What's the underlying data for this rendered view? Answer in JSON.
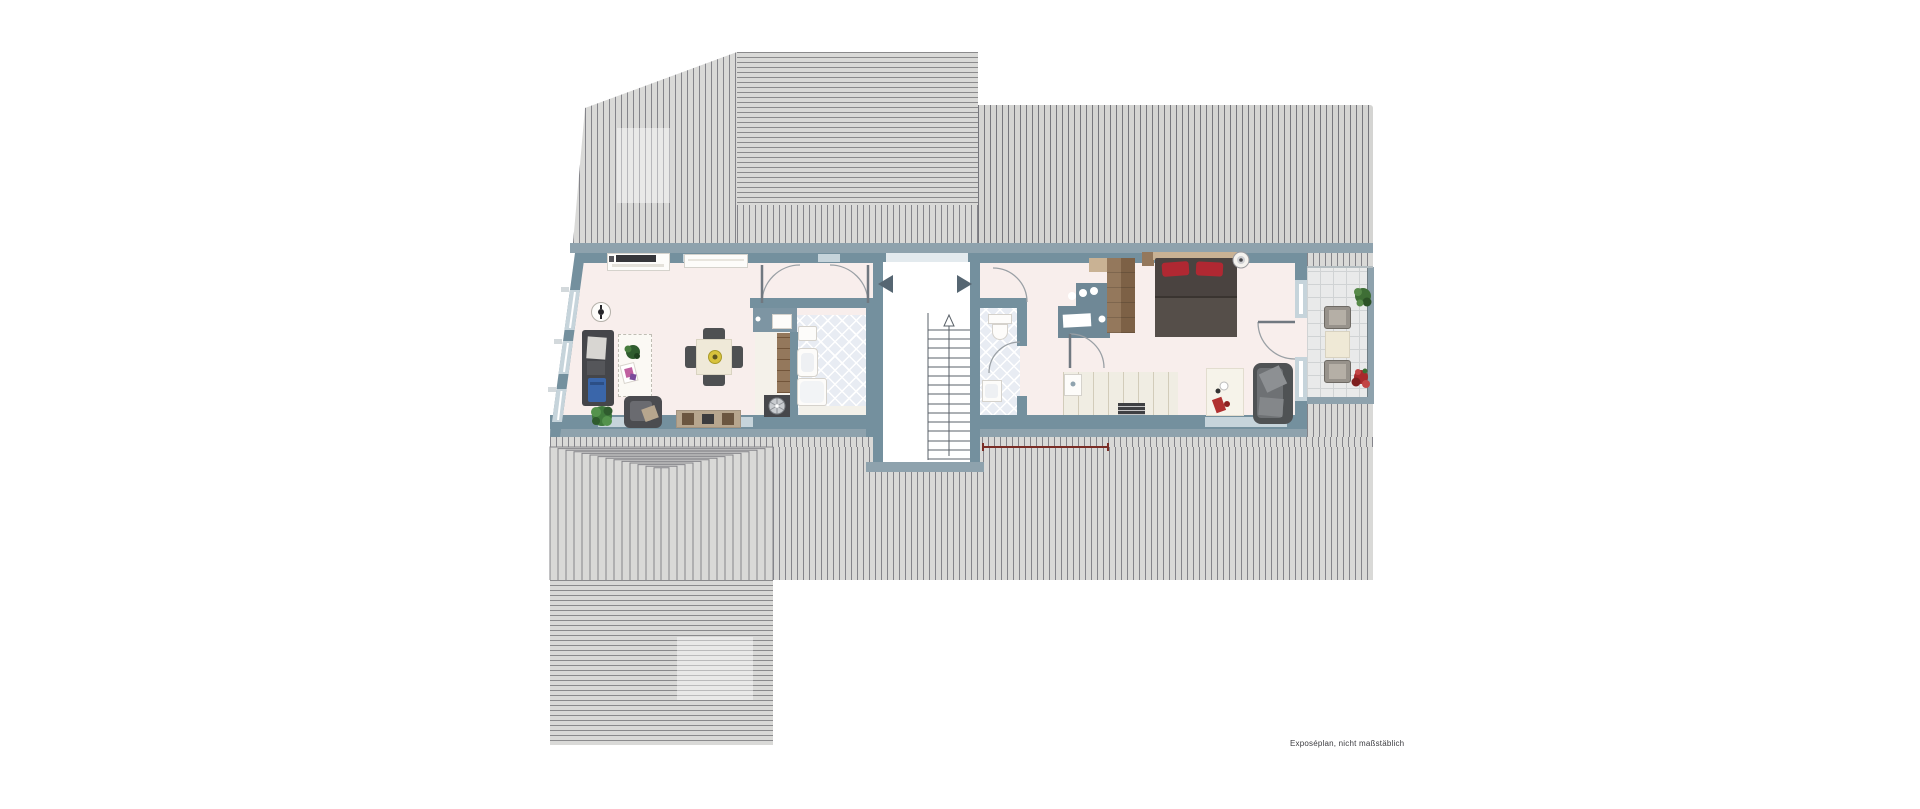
{
  "disclaimer": "Exposéplan, nicht maßstäblich",
  "colors": {
    "roof_field": "#d9d9d7",
    "roof_field_dark": "#d4d4d2",
    "roof_line": "#84848a",
    "eave": "#8ea2ad",
    "wall": "#74909e",
    "window": "#c6d4db",
    "floor": "#f8eeec",
    "tile_blue": "#e8ecf3",
    "balcony_tile": "#e9eaea",
    "counter": "#f0ede3",
    "wood": "#94785c",
    "wood_dark": "#7d6146",
    "bed": "#4a4340",
    "pillow_red": "#b02832",
    "sofa": "#45464a",
    "sofa_blue": "#3a66aa",
    "chair_gray": "#4e5052",
    "table_cream": "#efe9d8",
    "plant_green": "#3f7a3c",
    "flower_red": "#a8282c",
    "desk_slate": "#6f8896",
    "text": "#3c3c40"
  },
  "plan": {
    "type": "floor-plan",
    "level": "attic",
    "rooms_visible": [
      "living-dining",
      "bathroom-left",
      "utility-strip",
      "stair-landing",
      "staircase",
      "bathroom-right",
      "studio-room-with-kitchenette",
      "balcony"
    ],
    "furniture_icons": [
      "tv-lowboard",
      "wall-shelf",
      "wall-clock",
      "sofa",
      "coffee-rug",
      "armchair",
      "dining-table",
      "dining-chairs",
      "sideboard",
      "potted-plant",
      "vanity-basin",
      "shelf-column",
      "washing-machine",
      "shower-tray",
      "washbasin",
      "bathtub",
      "toilet",
      "desk",
      "wardrobe",
      "nightstand",
      "double-bed",
      "floor-lamp",
      "kitchen-counter",
      "cooktop-heater",
      "rug",
      "loveseat",
      "balcony-table",
      "balcony-chairs",
      "green-plant",
      "red-flower-plant"
    ]
  }
}
